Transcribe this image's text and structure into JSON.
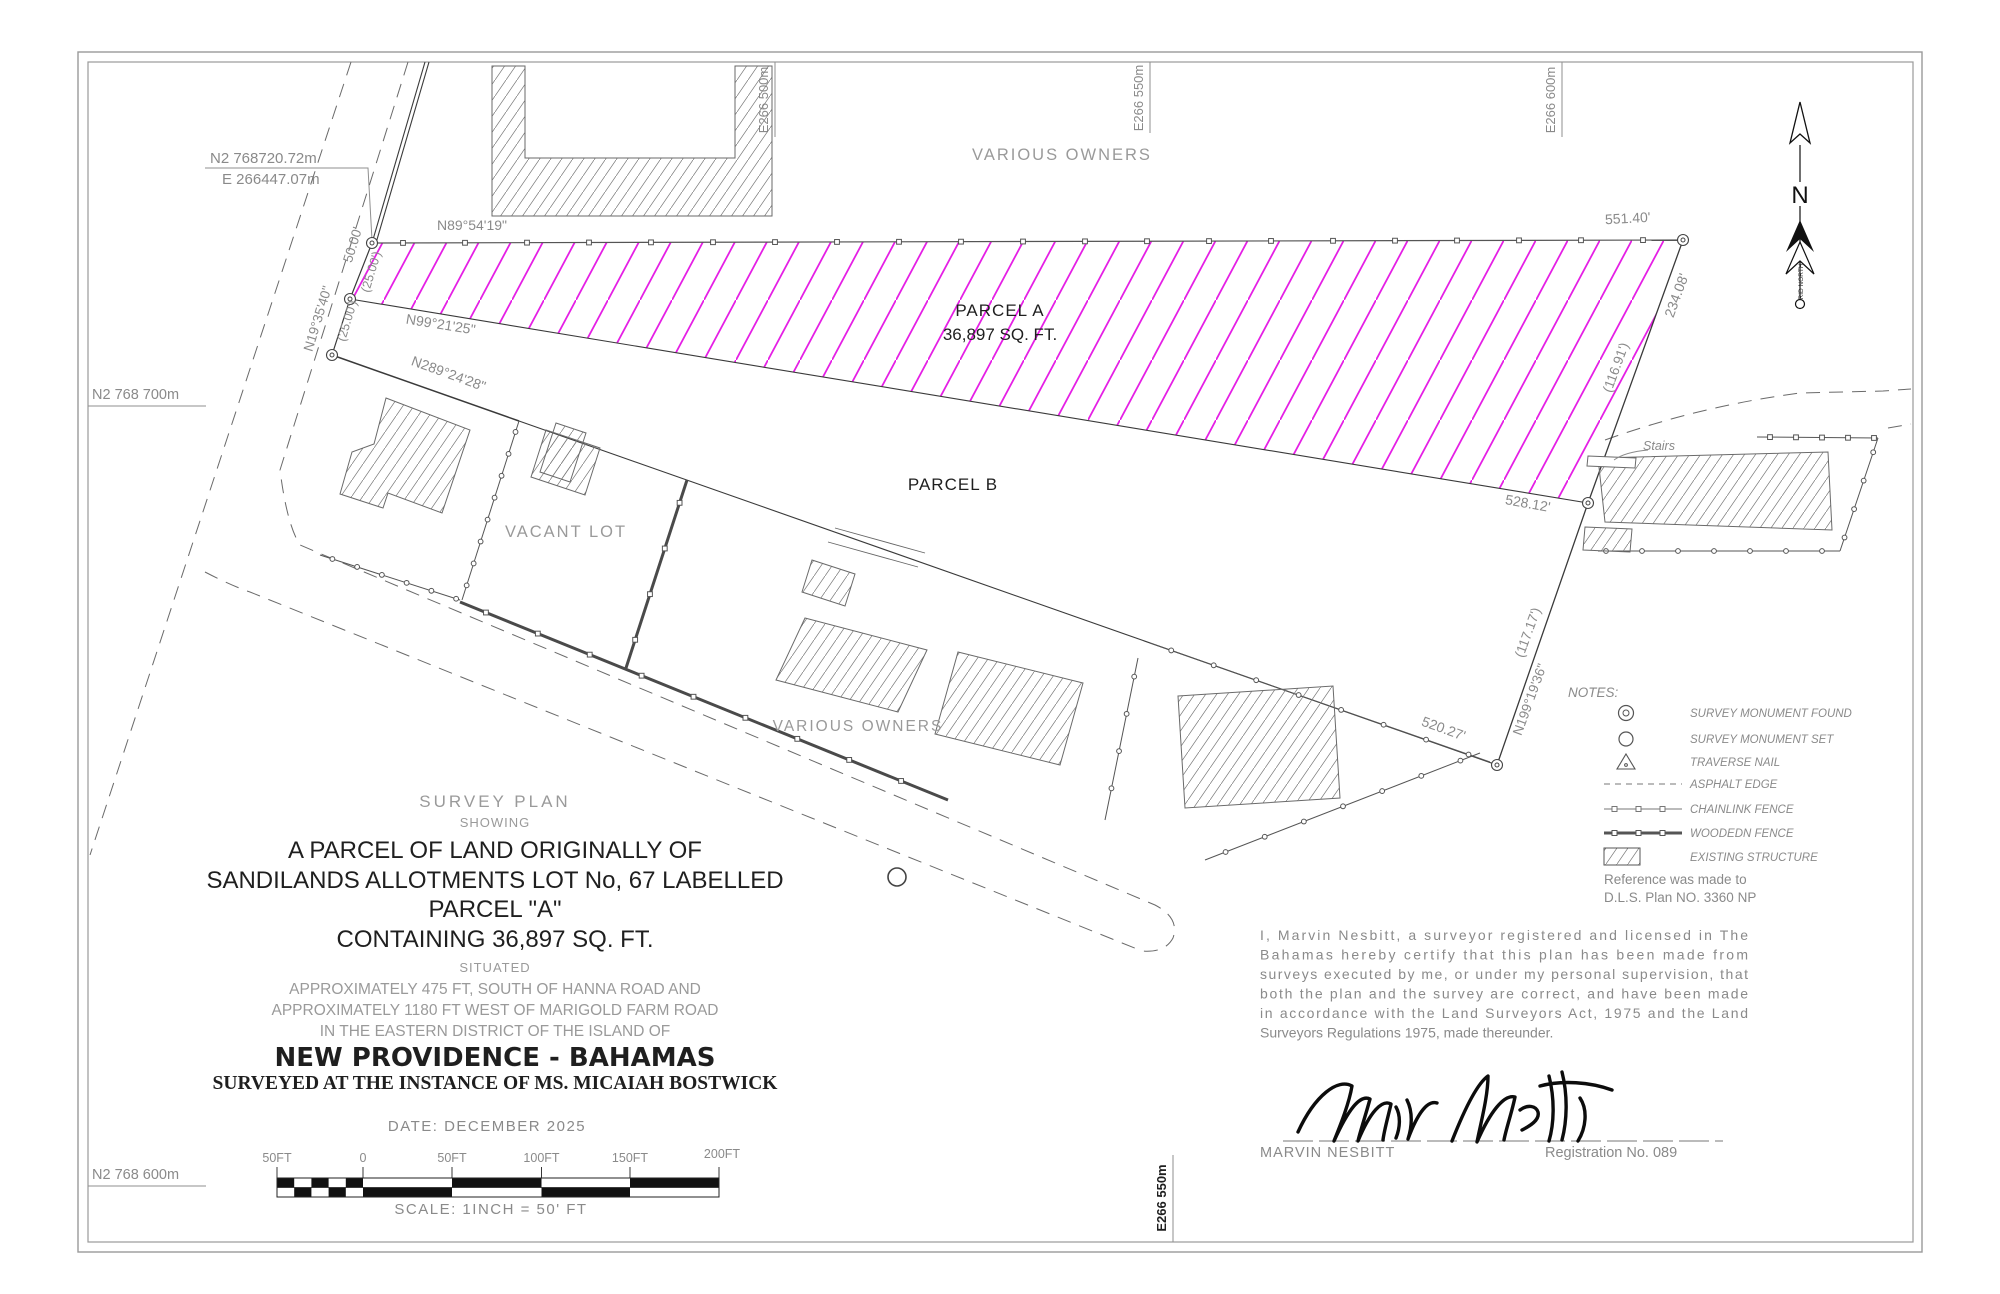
{
  "plan": {
    "grid": {
      "top_e500": "E266 500m",
      "top_e550": "E266 550m",
      "top_e600": "E266 600m",
      "bottom_e550": "E266 550m",
      "left_n700": "N2 768 700m",
      "left_n600": "N2 768 600m",
      "corner_label_n": "N2 768720.72m",
      "corner_label_e": "E 266447.07m"
    },
    "labels": {
      "various_owners_top": "VARIOUS OWNERS",
      "various_owners_bottom": "VARIOUS OWNERS",
      "parcel_a": "PARCEL A",
      "parcel_a_area": "36,897 SQ. FT.",
      "parcel_b": "PARCEL B",
      "vacant_lot": "VACANT LOT",
      "stairs": "Stairs"
    },
    "bearings": {
      "north_line": "N89°54'19\"",
      "dim_551": "551.40'",
      "parcel_a_south": "N99°21'25\"",
      "strip_south": "N289°24'28\"",
      "road_line": "N19°35'40\"",
      "dim_50": "50.00'",
      "dim_25_a": "(25.00')",
      "dim_25_b": "(25.00')",
      "dim_234": "234.08'",
      "dim_116": "(116.91')",
      "dim_528": "528.12'",
      "dim_117": "(117.17')",
      "east_line": "N199°19'36\"",
      "dim_520": "520.27'"
    },
    "north_arrow": {
      "letter": "N",
      "caption": "GRID NORTH"
    }
  },
  "legend": {
    "title": "NOTES:",
    "items": [
      {
        "label": "SURVEY MONUMENT FOUND"
      },
      {
        "label": "SURVEY MONUMENT SET"
      },
      {
        "label": "TRAVERSE NAIL"
      },
      {
        "label": "ASPHALT EDGE"
      },
      {
        "label": "CHAINLINK FENCE"
      },
      {
        "label": "WOODEDN FENCE"
      },
      {
        "label": "EXISTING STRUCTURE"
      }
    ],
    "reference_line1": "Reference was made to",
    "reference_line2": "D.L.S. Plan NO. 3360 NP"
  },
  "title_block": {
    "line1": "SURVEY PLAN",
    "line2": "SHOWING",
    "line3": "A PARCEL OF LAND ORIGINALLY OF",
    "line4": "SANDILANDS ALLOTMENTS LOT No, 67 LABELLED",
    "line5": "PARCEL \"A\"",
    "line6": "CONTAINING  36,897 SQ. FT.",
    "line7": "SITUATED",
    "line8": "APPROXIMATELY 475 FT, SOUTH OF HANNA ROAD AND",
    "line9": "APPROXIMATELY 1180 FT WEST OF MARIGOLD FARM ROAD",
    "line10": "IN THE EASTERN DISTRICT OF THE ISLAND OF",
    "line11": "NEW PROVIDENCE - BAHAMAS",
    "line12": "SURVEYED AT THE INSTANCE OF MS. MICAIAH BOSTWICK"
  },
  "certificate": {
    "lines": [
      "I, Marvin Nesbitt, a surveyor registered and licensed in The",
      "Bahamas hereby certify that this plan has been made from",
      "surveys executed by me, or under my personal supervision, that",
      "both the plan and the survey are correct, and have been made",
      "in accordance with the Land Surveyors Act, 1975 and the Land",
      "Surveyors Regulations 1975, made thereunder."
    ],
    "signatory": "MARVIN NESBITT",
    "registration": "Registration No. 089"
  },
  "scale_bar": {
    "date": "DATE: DECEMBER 2025",
    "scale": "SCALE: 1INCH = 50' FT",
    "ticks": [
      "50FT",
      "0",
      "50FT",
      "100FT",
      "150FT",
      "200FT"
    ]
  },
  "colors": {
    "parcel_a_hatch": "#e51fe5",
    "line_dark": "#2a2a2a",
    "text_gray": "#8a8a8a"
  }
}
